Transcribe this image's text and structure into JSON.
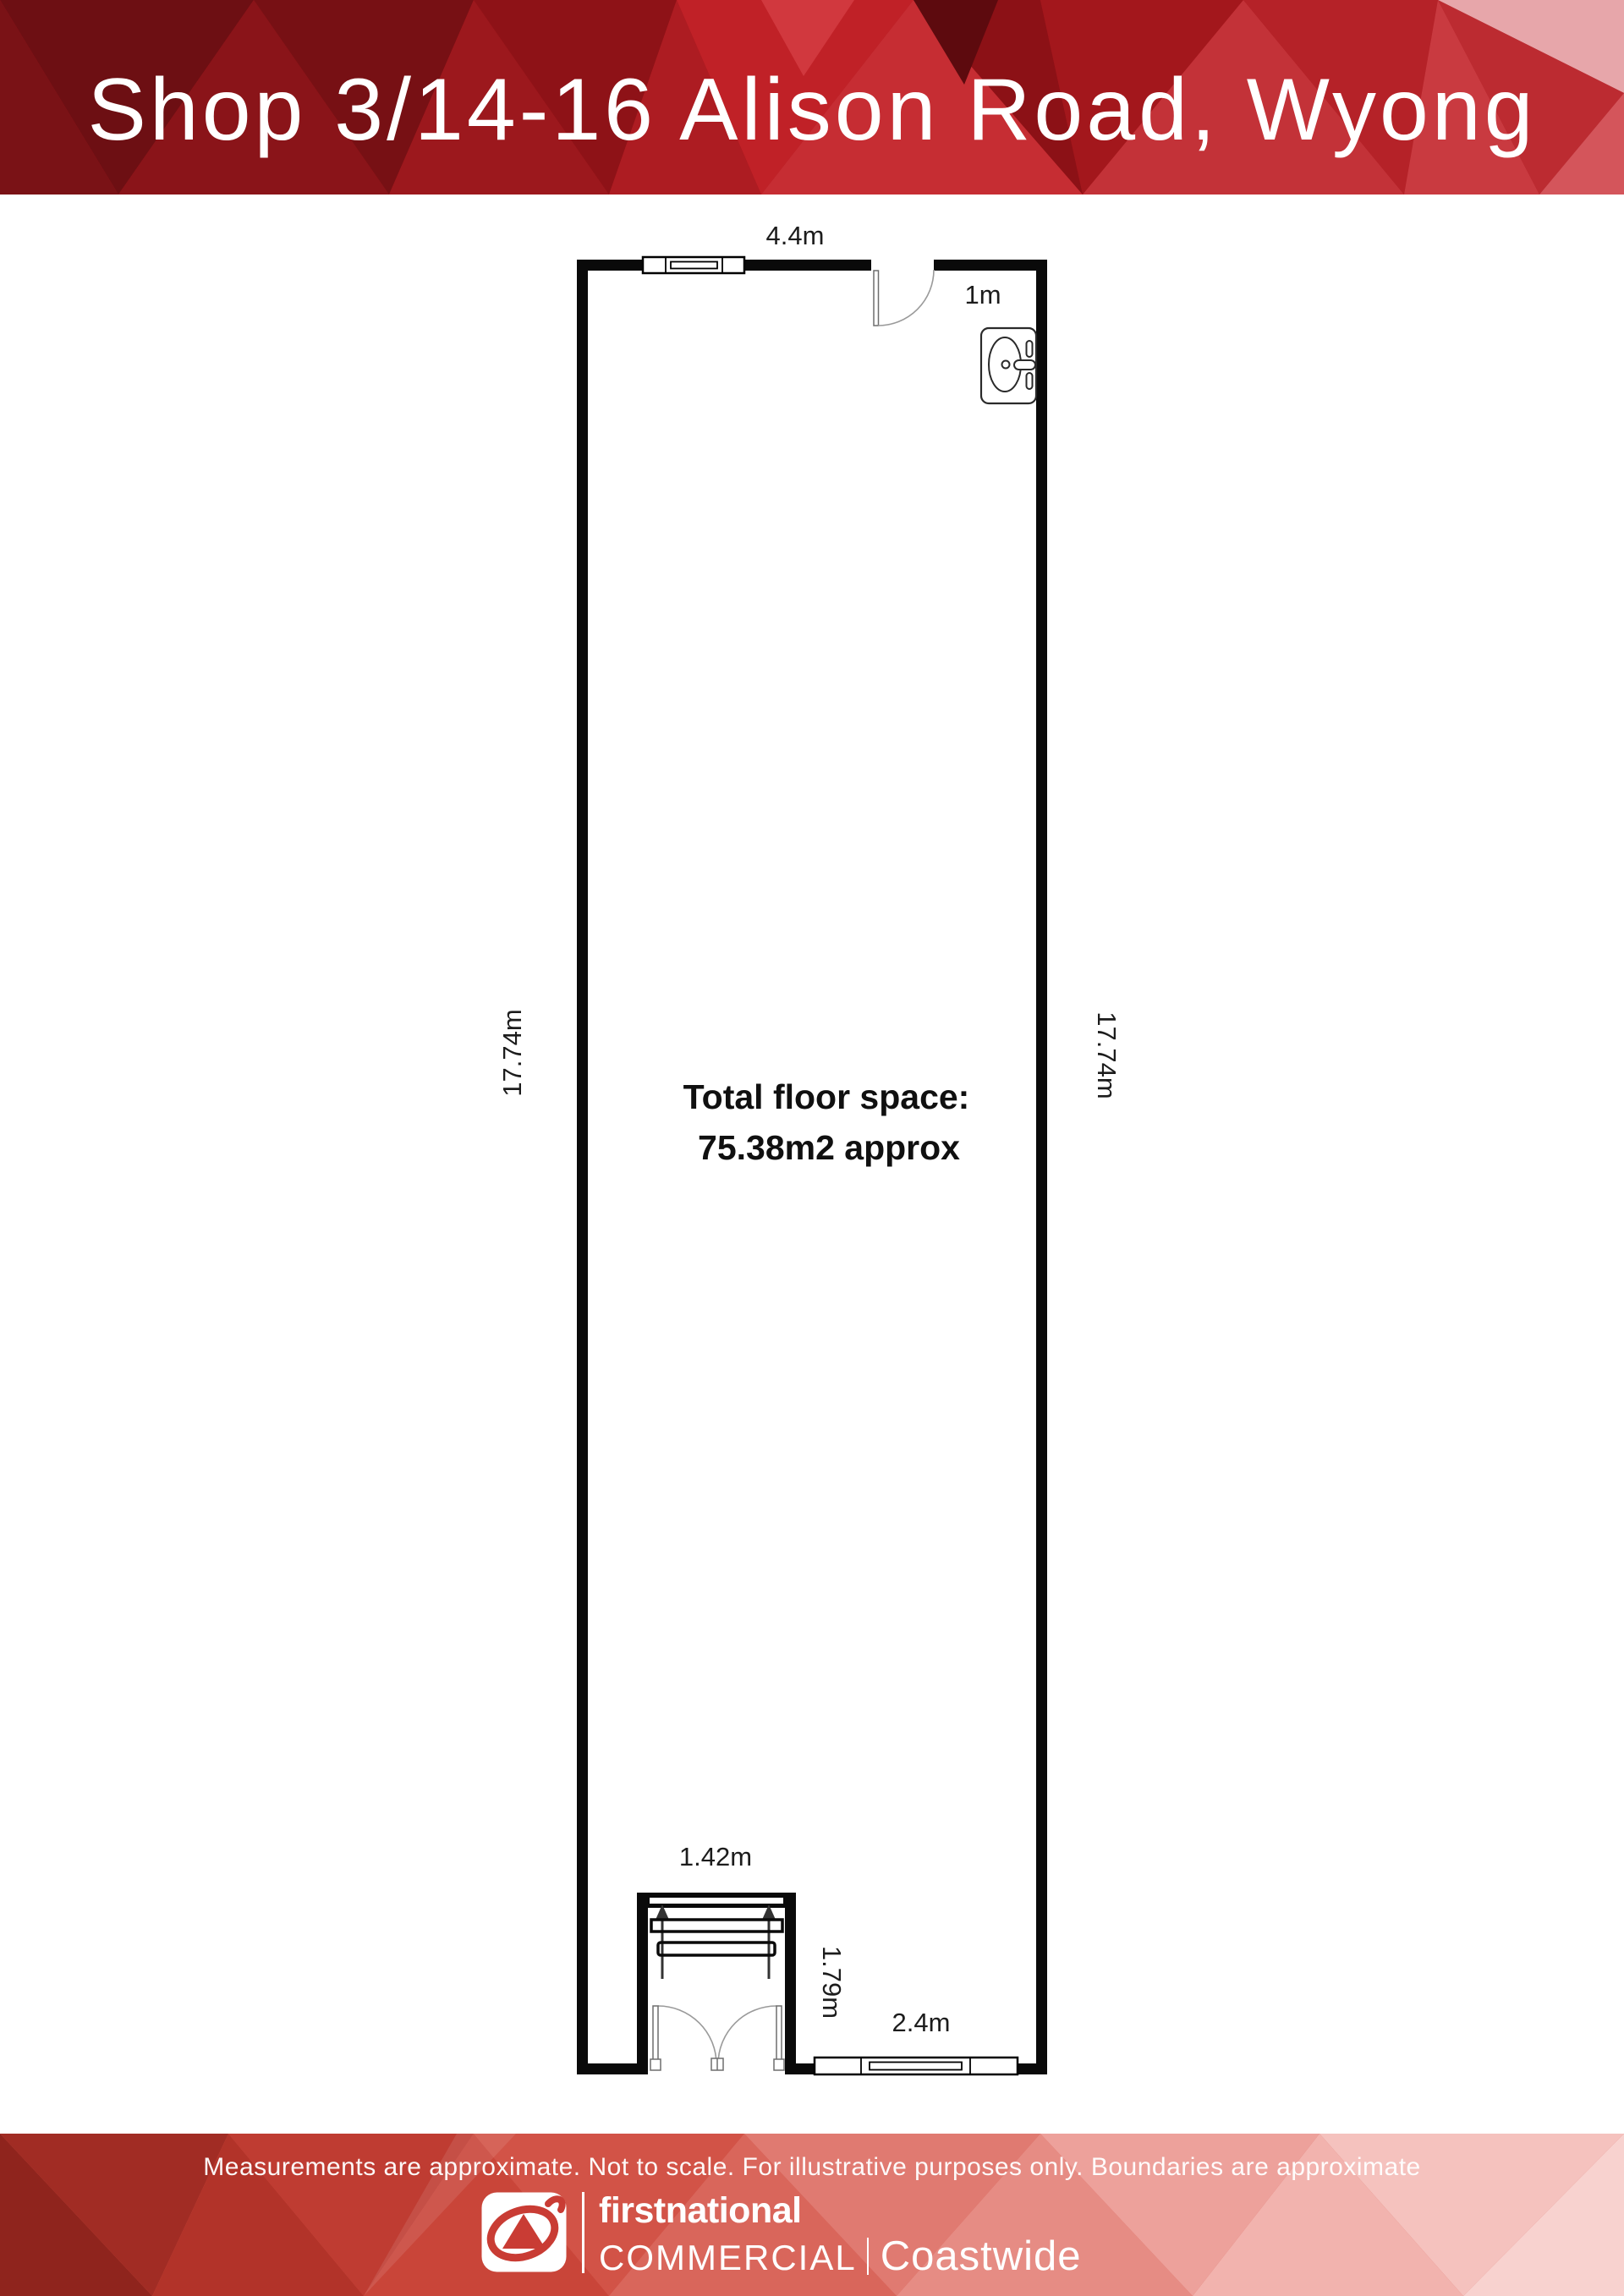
{
  "header": {
    "title": "Shop 3/14-16 Alison Road, Wyong"
  },
  "floorplan": {
    "labels": {
      "top_width": "4.4m",
      "door_width": "1m",
      "side_left": "17.74m",
      "side_right": "17.74m",
      "area_line1": "Total floor space:",
      "area_line2": "75.38m2 approx",
      "entry_width": "1.42m",
      "entry_depth": "1.79m",
      "bottom_window_width": "2.4m"
    },
    "icons": {
      "basin": "basin-top-view-icon",
      "top_door": "door-swing-arc-icon",
      "entry_doors": "double-door-swing-icon",
      "entry_direction": "up-arrow-icon",
      "windows": "window-glazing-icon"
    },
    "wall_color": "#0a0a0a"
  },
  "footer": {
    "disclaimer": "Measurements are approximate. Not to scale. For illustrative purposes only. Boundaries are approximate",
    "brand": {
      "name": "firstnational",
      "division": "COMMERCIAL",
      "office": "Coastwide"
    }
  },
  "colors": {
    "header_base_red": "#a9161c",
    "header_dark_maroon": "#6d0f13",
    "header_bright_red": "#c02127",
    "header_pale_pink": "#e7a6aa",
    "footer_base": "#d2564c",
    "footer_dark": "#8f241d",
    "footer_pale": "#f8d2cf",
    "logo_red": "#c93c34"
  }
}
